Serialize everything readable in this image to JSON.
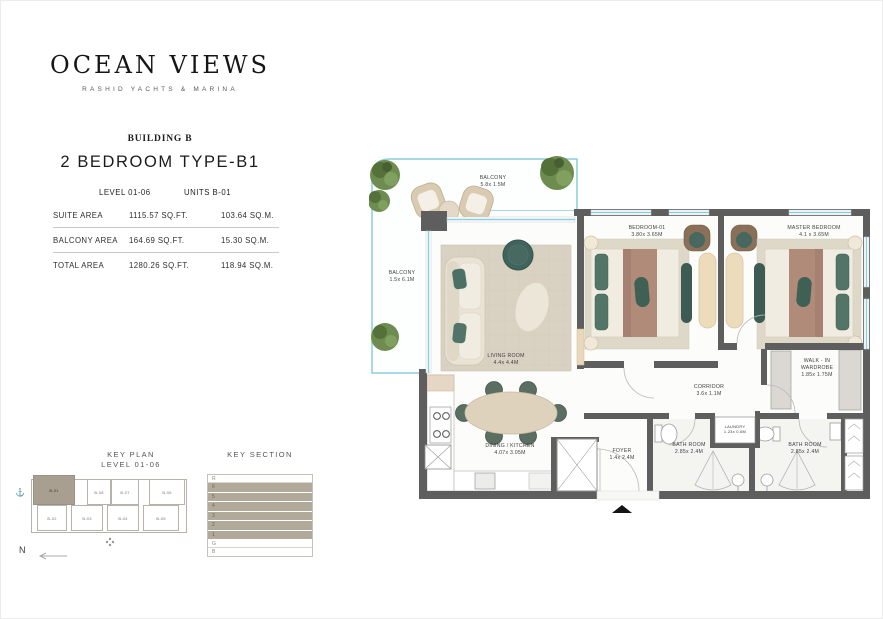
{
  "brand": {
    "logo": "OCEAN VIEWS",
    "tagline": "RASHID YACHTS & MARINA"
  },
  "header": {
    "building": "BUILDING B",
    "unit_type": "2 BEDROOM TYPE-B1"
  },
  "area_table": {
    "level": "LEVEL 01-06",
    "units": "UNITS B-01",
    "rows": [
      {
        "label": "SUITE AREA",
        "sqft": "1115.57 SQ.FT.",
        "sqm": "103.64 SQ.M."
      },
      {
        "label": "BALCONY AREA",
        "sqft": "164.69 SQ.FT.",
        "sqm": "15.30 SQ.M."
      },
      {
        "label": "TOTAL AREA",
        "sqft": "1280.26 SQ.FT.",
        "sqm": "118.94 SQ.M."
      }
    ]
  },
  "key_plan": {
    "title": "KEY PLAN",
    "subtitle": "LEVEL 01-06",
    "north": "N",
    "units": [
      "B-01",
      "B-08",
      "B-07",
      "B-06",
      "B-02",
      "B-03",
      "B-04",
      "B-05"
    ],
    "highlighted_unit": "B-01"
  },
  "key_section": {
    "title": "KEY SECTION",
    "levels": [
      "R",
      "6",
      "5",
      "4",
      "3",
      "2",
      "1",
      "G",
      "B"
    ],
    "highlighted_levels": [
      "6",
      "5",
      "4",
      "3",
      "2",
      "1"
    ]
  },
  "floor_plan": {
    "rooms": {
      "balcony_top": {
        "name": "BALCONY",
        "dims": "5.8x 1.5M"
      },
      "balcony_left": {
        "name": "BALCONY",
        "dims": "1.5x 6.1M"
      },
      "living_room": {
        "name": "LIVING ROOM",
        "dims": "4.4x 4.4M"
      },
      "bedroom_01": {
        "name": "BEDROOM-01",
        "dims": "3.80x 3.65M"
      },
      "master_bedroom": {
        "name": "MASTER BEDROOM",
        "dims": "4.1 x 3.65M"
      },
      "walk_in_wardrobe": {
        "line1": "WALK - IN",
        "line2": "WARDROBE",
        "dims": "1.85x 1.75M"
      },
      "corridor": {
        "name": "CORRIDOR",
        "dims": "3.6x 1.1M"
      },
      "dining_kitchen": {
        "name": "DINING / KITCHEN",
        "dims": "4.07x 3.05M"
      },
      "laundry": {
        "name": "LAUNDRY",
        "dims": "1.23x 0.6M"
      },
      "foyer": {
        "name": "FOYER",
        "dims": "1.4x 2.4M"
      },
      "bathroom_1": {
        "name": "BATH ROOM",
        "dims": "2.85x 2.4M"
      },
      "bathroom_2": {
        "name": "BATH ROOM",
        "dims": "2.85x 2.4M"
      }
    }
  },
  "icons": {
    "anchor": "⚓"
  },
  "colors": {
    "wall": "#5e5e5e",
    "balcony_outline": "#8ecbdb",
    "highlight_taupe": "#a89f90",
    "furniture_teal": "#4e7168",
    "furniture_wood": "#b08a78",
    "greenery": "#5d7a44"
  }
}
